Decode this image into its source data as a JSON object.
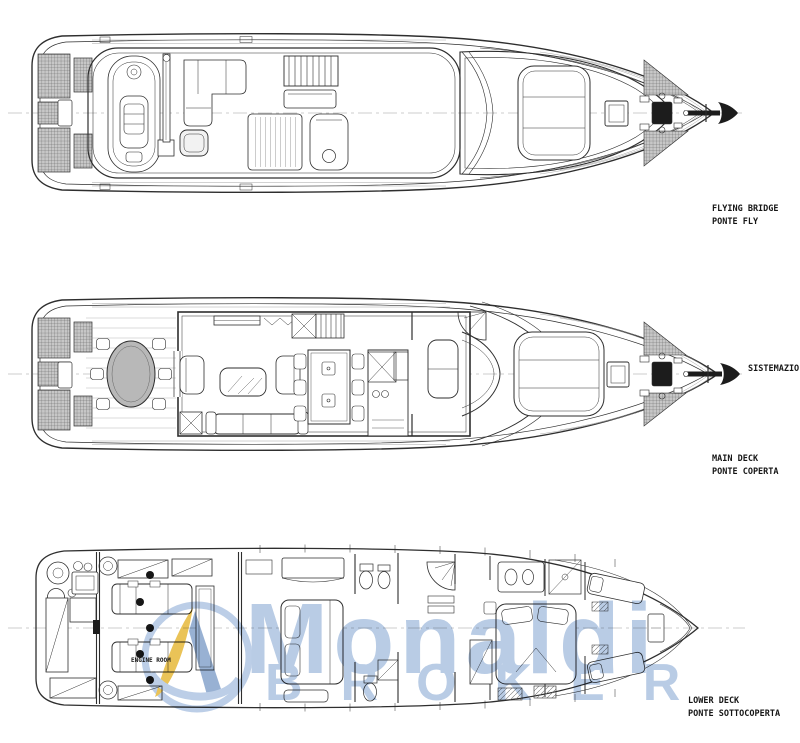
{
  "page": {
    "background": "#ffffff",
    "line_color": "#2e2e2e"
  },
  "deck_labels": {
    "flying_bridge": {
      "line1": "FLYING BRIDGE",
      "line2": "PONTE FLY"
    },
    "main_deck": {
      "line1": "MAIN DECK",
      "line2": "PONTE COPERTA"
    },
    "lower_deck": {
      "line1": "LOWER DECK",
      "line2": "PONTE SOTTOCOPERTA"
    },
    "side_note": "SISTEMAZIO",
    "engine_room": "ENGINE ROOM"
  },
  "watermark": {
    "brand": "Monaldi",
    "brand_sub": "BROKER",
    "text_color": "#afc5e2",
    "logo": {
      "ring": "#b3c8e4",
      "sail_yellow": "#e7bb3f",
      "sail_blue": "#8aa6cd"
    }
  },
  "drawing": {
    "decks": [
      "Flying bridge",
      "Main deck",
      "Lower deck"
    ],
    "hatch_fill": "#c7c7c7",
    "table_fill": "#b8b8b8"
  }
}
